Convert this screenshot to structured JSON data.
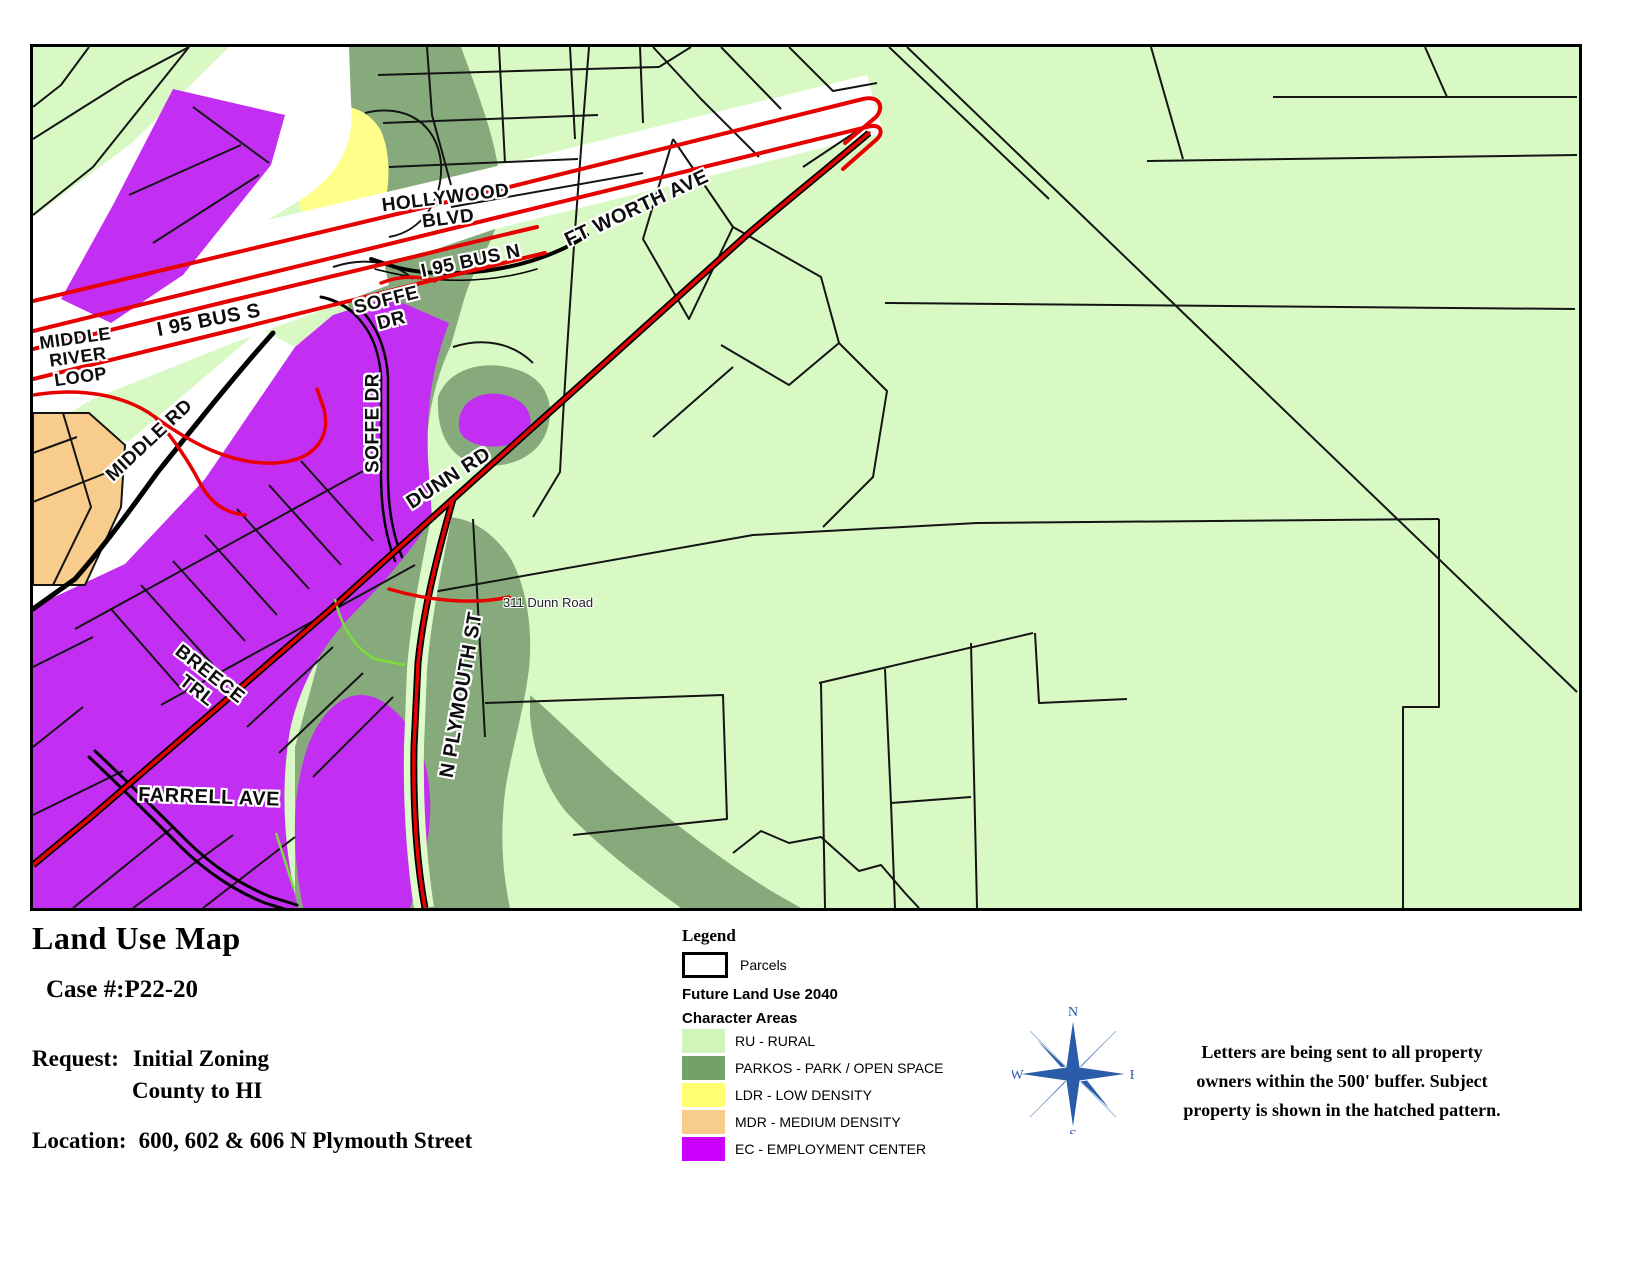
{
  "map": {
    "labels": {
      "middle_river_loop": "MIDDLE\nRIVER\nLOOP",
      "i95_bus_s": "I 95 BUS S",
      "soffe_dr": "SOFFE\nDR",
      "middle_rd": "MIDDLE RD",
      "soffe_dr_vertical": "SOFFE DR",
      "dunn_rd": "DUNN RD",
      "hollywood_blvd": "HOLLYWOOD\nBLVD",
      "i95_bus_n": "I 95 BUS N",
      "ft_worth_ave": "FT WORTH AVE",
      "address_311": "311 Dunn Road",
      "n_plymouth_st": "N PLYMOUTH ST",
      "breece_trl": "BREECE\nTRL",
      "farrell_ave": "FARRELL AVE"
    }
  },
  "title_block": {
    "title": "Land Use Map",
    "case_number": "Case #:P22-20",
    "request_label": "Request:",
    "request_value_line1": "Initial Zoning",
    "request_value_line2": "County to HI",
    "location_label": "Location:",
    "location_value": "600, 602 & 606 N Plymouth Street"
  },
  "legend": {
    "heading": "Legend",
    "parcels_label": "Parcels",
    "future_land_use_heading": "Future Land Use 2040",
    "character_areas_heading": "Character Areas",
    "items": [
      {
        "code": "RU",
        "label": "RU - RURAL",
        "color": "#d2f4ba"
      },
      {
        "code": "PARKOS",
        "label": "PARKOS - PARK / OPEN SPACE",
        "color": "#73a268"
      },
      {
        "code": "LDR",
        "label": "LDR - LOW DENSITY",
        "color": "#ffff73"
      },
      {
        "code": "MDR",
        "label": "MDR - MEDIUM DENSITY",
        "color": "#f8cc8a"
      },
      {
        "code": "EC",
        "label": "EC - EMPLOYMENT CENTER",
        "color": "#ca00fa"
      }
    ]
  },
  "compass": {
    "north": "N",
    "east": "E",
    "south": "S",
    "west": "W"
  },
  "note": "Letters are being sent to all property\nowners within the 500' buffer.  Subject\nproperty is shown in the hatched pattern."
}
